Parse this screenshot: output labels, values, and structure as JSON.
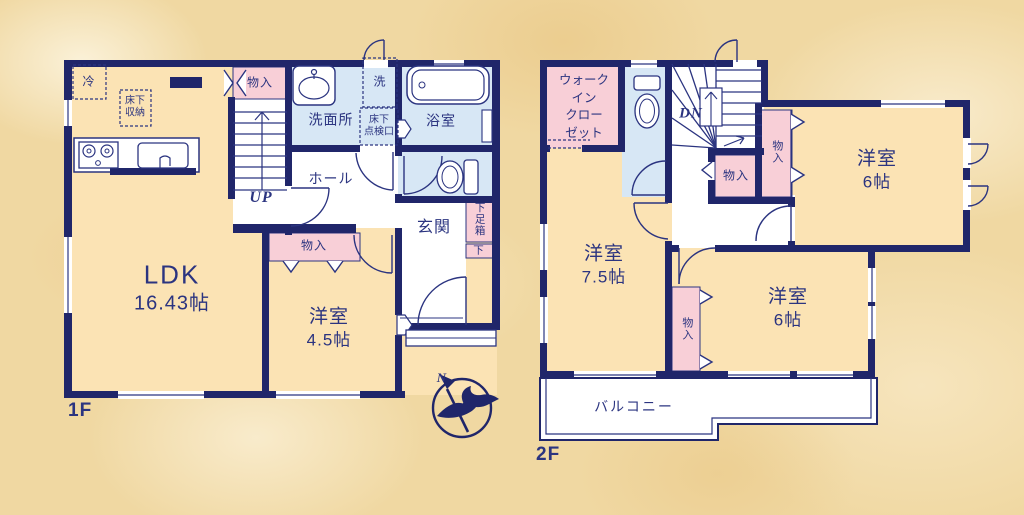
{
  "title": "住宅間取り図 1F・2F",
  "colors": {
    "wall": "#20266a",
    "ink": "#2b3480",
    "room_fill": "#fbe3b4",
    "closet_fill": "#f8cfd7",
    "wet_area_fill": "#d7e7f5",
    "background": "#f0d8a2",
    "white": "#ffffff"
  },
  "floor1": {
    "floor_label": "1F",
    "ldk": {
      "name": "LDK",
      "size": "16.43帖"
    },
    "youshitsu_45": {
      "name": "洋室",
      "size": "4.5帖"
    },
    "senmenjo": "洗面所",
    "yokushitsu": "浴室",
    "hall": "ホール",
    "genkan": "玄関",
    "monoire_top": "物入",
    "monoire_mid": "物入",
    "reizouko": "冷",
    "yukashita_shuno_lines": [
      "床下",
      "収納"
    ],
    "sentaku": "洗",
    "tenkenkou_lines": [
      "床下",
      "点検口"
    ],
    "getabako": "下足箱",
    "getabako_shita": "下",
    "stairs_up": "UP",
    "compass_north": "N"
  },
  "floor2": {
    "floor_label": "2F",
    "wic_lines": [
      "ウォーク",
      "イン",
      "クロー",
      "ゼット"
    ],
    "youshitsu_75": {
      "name": "洋室",
      "size": "7.5帖"
    },
    "youshitsu_6_ne": {
      "name": "洋室",
      "size": "6帖"
    },
    "youshitsu_6_se": {
      "name": "洋室",
      "size": "6帖"
    },
    "monoire_stair": "物入",
    "monoire_tall": "物入",
    "monoire_mid": "物入",
    "balcony": "バルコニー",
    "stairs_dn": "DN"
  }
}
